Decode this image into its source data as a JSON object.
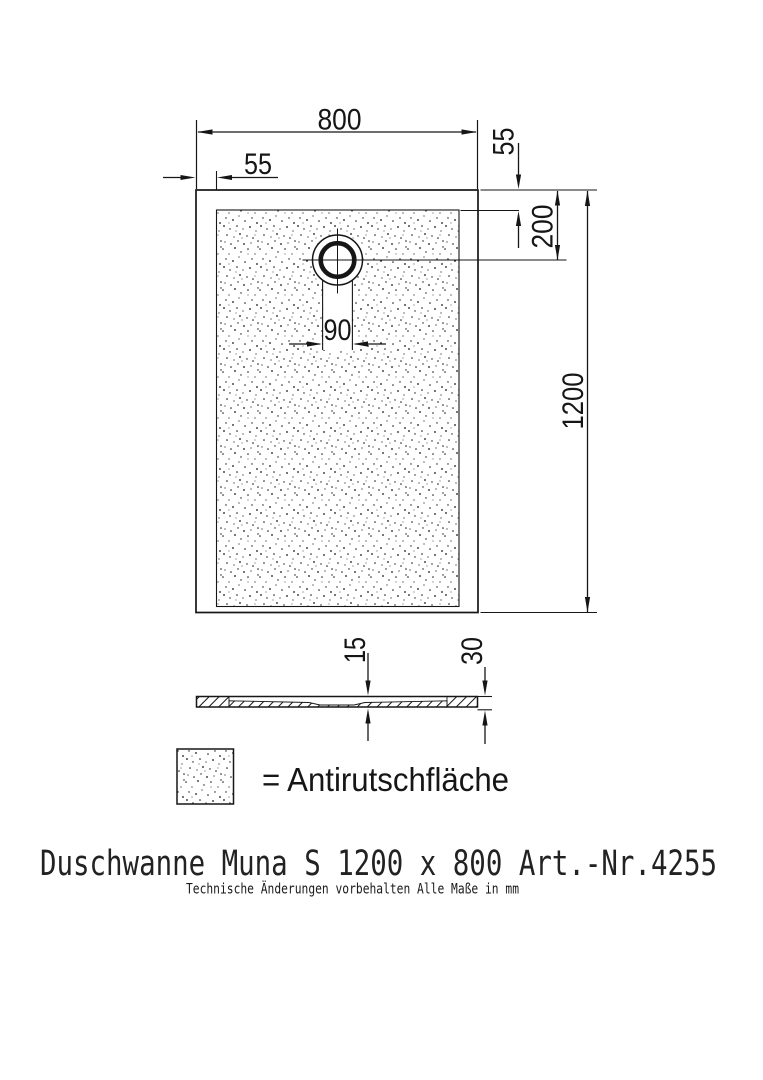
{
  "drawing": {
    "dims": {
      "width_top": "800",
      "rim_left": "55",
      "rim_top": "55",
      "drain_center_offset": "200",
      "drain_opening": "90",
      "length_right": "1200",
      "floor_thickness": "15",
      "edge_height": "30"
    },
    "legend": {
      "label": "= Antirutschfläche"
    },
    "title": "Duschwanne Muna S 1200 x 800 Art.-Nr.4255",
    "subtitle": "Technische Änderungen vorbehalten  Alle Maße in mm",
    "colors": {
      "line": "#161616",
      "background": "#ffffff"
    }
  }
}
